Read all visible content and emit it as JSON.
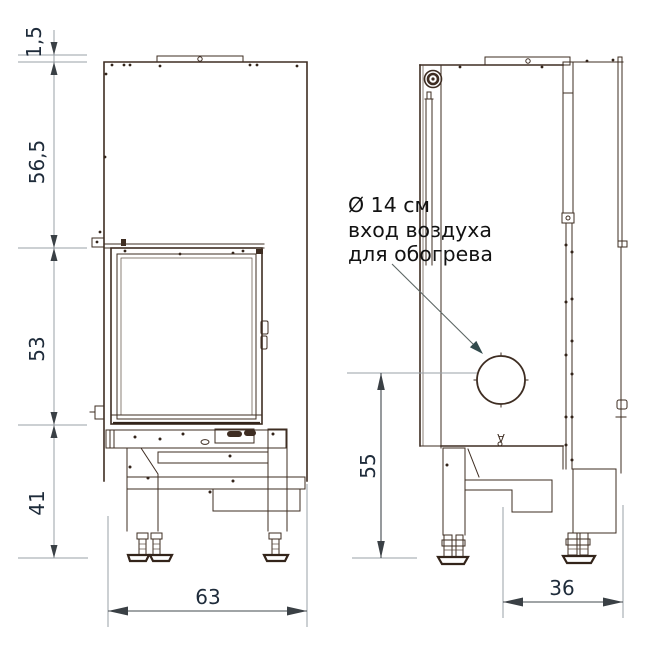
{
  "annotation": {
    "line1": "Ø 14 см",
    "line2": "вход воздуха",
    "line3": "для обогрева"
  },
  "dimensions": {
    "top_plate_thickness": "1,5",
    "upper_body_height": "56,5",
    "door_height": "53",
    "base_height": "41",
    "front_width": "63",
    "inlet_center_height": "55",
    "base_depth": "36"
  },
  "marks": {
    "section_mark": "∀"
  },
  "colors": {
    "drawing_line": "#3e2d22",
    "dimension_line": "#9aa1a7",
    "dimension_text": "#1e2b3a",
    "annotation_text": "#121212",
    "leader_arrow": "#324a4c"
  }
}
